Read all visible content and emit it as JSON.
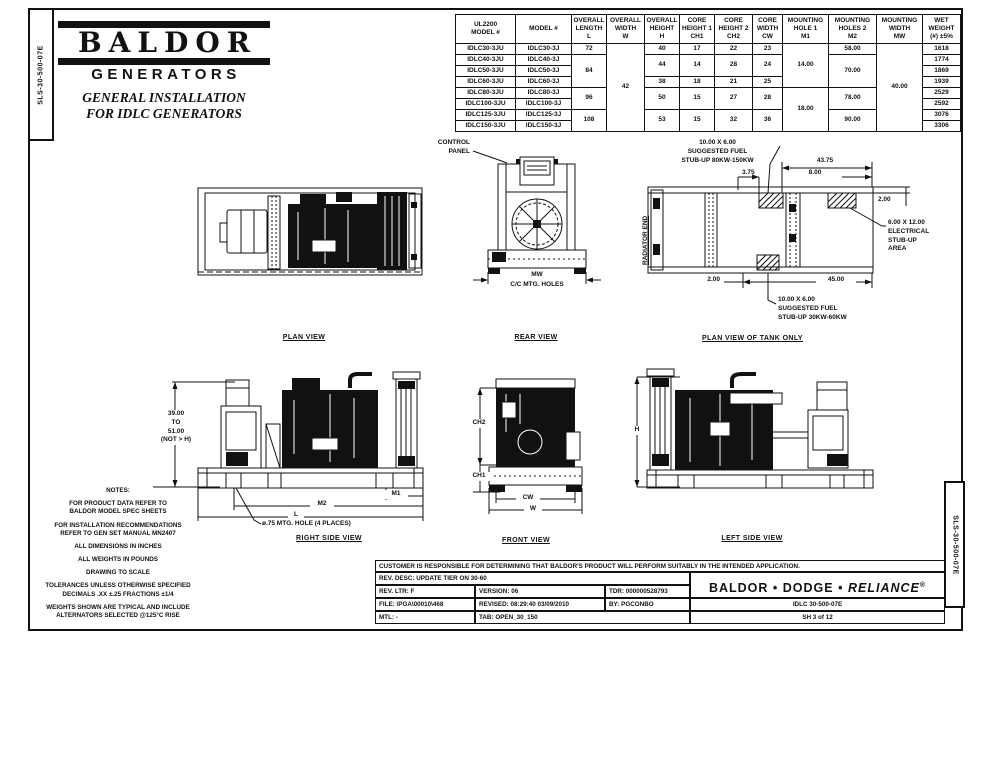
{
  "colors": {
    "ink": "#111111",
    "paper": "#ffffff"
  },
  "page": {
    "side_code": "SLS-30-500-07E"
  },
  "logo": {
    "brand": "BALDOR",
    "division": "GENERATORS",
    "subtitle": "GENERAL INSTALLATION\nFOR IDLC GENERATORS"
  },
  "table": {
    "headers": [
      "UL2200\nMODEL #",
      "MODEL #",
      "OVERALL\nLENGTH\nL",
      "OVERALL\nWIDTH\nW",
      "OVERALL\nHEIGHT\nH",
      "CORE\nHEIGHT 1\nCH1",
      "CORE\nHEIGHT 2\nCH2",
      "CORE\nWIDTH\nCW",
      "MOUNTING\nHOLE 1\nM1",
      "MOUNTING\nHOLES 2\nM2",
      "MOUNTING\nWIDTH\nMW",
      "WET\nWEIGHT\n(#) ±5%"
    ],
    "rows": [
      {
        "u": "IDLC30-3JU",
        "m": "IDLC30-3J",
        "l": "72",
        "w": "42",
        "h": "40",
        "ch1": "17",
        "ch2": "22",
        "cw": "23",
        "m1": "14.00",
        "m2": "58.00",
        "mw": "40.00",
        "wt": "1618"
      },
      {
        "u": "IDLC40-3JU",
        "m": "IDLC40-3J",
        "l": "84",
        "h": "44",
        "ch1": "14",
        "ch2": "28",
        "cw": "24",
        "m2": "70.00",
        "wt": "1774"
      },
      {
        "u": "IDLC50-3JU",
        "m": "IDLC50-3J",
        "wt": "1869"
      },
      {
        "u": "IDLC60-3JU",
        "m": "IDLC60-3J",
        "h": "38",
        "ch1": "18",
        "ch2": "21",
        "cw": "25",
        "wt": "1939"
      },
      {
        "u": "IDLC80-3JU",
        "m": "IDLC80-3J",
        "l": "96",
        "h": "50",
        "ch1": "15",
        "ch2": "27",
        "cw": "28",
        "m1": "18.00",
        "m2": "78.00",
        "wt": "2529"
      },
      {
        "u": "IDLC100-3JU",
        "m": "IDLC100-3J",
        "wt": "2592"
      },
      {
        "u": "IDLC125-3JU",
        "m": "IDLC125-3J",
        "l": "108",
        "h": "53",
        "ch1": "15",
        "ch2": "32",
        "cw": "36",
        "m2": "90.00",
        "wt": "3076"
      },
      {
        "u": "IDLC150-3JU",
        "m": "IDLC150-3J",
        "wt": "3306"
      }
    ]
  },
  "views": {
    "plan": {
      "label": "PLAN VIEW"
    },
    "rear": {
      "label": "REAR VIEW",
      "control_panel": "CONTROL\nPANEL",
      "dim_mw": "MW",
      "dim_mw_note": "C/C MTG. HOLES"
    },
    "tank": {
      "label": "PLAN VIEW OF TANK ONLY",
      "radiator_end": "RADIATOR END",
      "fuel_top": "10.00 X 6.00\nSUGGESTED FUEL\nSTUB-UP 80KW-150KW",
      "fuel_bottom": "10.00 X 6.00\nSUGGESTED FUEL\nSTUB-UP 30KW-60KW",
      "electrical": "6.00 X 12.00\nELECTRICAL\nSTUB-UP\nAREA",
      "dim_43_75": "43.75",
      "dim_3_75": "3.75",
      "dim_8_00": "8.00",
      "dim_2_00_right": "2.00",
      "dim_2_00_left": "2.00",
      "dim_45_00": "45.00"
    },
    "right_side": {
      "label": "RIGHT SIDE VIEW",
      "dim_height": "39.00\nTO\n51.00\n(NOT > H)",
      "dim_m1": "M1",
      "dim_m2": "M2",
      "dim_l": "L",
      "mtg_note": "ø.75 MTG. HOLE (4 PLACES)"
    },
    "front": {
      "label": "FRONT VIEW",
      "dim_ch2": "CH2",
      "dim_ch1": "CH1",
      "dim_cw": "CW",
      "dim_w": "W"
    },
    "left_side": {
      "label": "LEFT SIDE VIEW",
      "dim_h": "H"
    }
  },
  "notes": {
    "title": "NOTES:",
    "items": [
      "FOR PRODUCT DATA REFER TO\nBALDOR MODEL SPEC SHEETS",
      "FOR INSTALLATION RECOMMENDATIONS\nREFER TO GEN SET MANUAL MN2407",
      "ALL DIMENSIONS IN INCHES",
      "ALL WEIGHTS IN POUNDS",
      "DRAWING TO SCALE",
      "TOLERANCES UNLESS OTHERWISE SPECIFIED\nDECIMALS .XX ±.25   FRACTIONS ±1/4",
      "WEIGHTS SHOWN ARE TYPICAL AND INCLUDE\nALTERNATORS SELECTED @125°C RISE"
    ]
  },
  "title_block": {
    "disclaimer": "CUSTOMER IS RESPONSIBLE FOR DETERMINING THAT BALDOR'S PRODUCT WILL PERFORM SUITABLY IN THE INTENDED APPLICATION.",
    "rev_desc": "REV. DESC:  UPDATE TIER ON 30-60",
    "rev_ltr": "REV. LTR:  F",
    "version": "VERSION: 06",
    "tdr": "TDR: 000000528793",
    "file": "FILE: \\PGA\\00010\\468",
    "revised": "REVISED: 08:29:40  03/09/2010",
    "by": "BY:  PGCONBO",
    "mtl": "MTL: -",
    "tab": "TAB:   OPEN_30_150",
    "brand_baldor": "BALDOR",
    "brand_sep": "•",
    "brand_dodge": "DODGE",
    "brand_reliance": "RELIANCE",
    "brand_reg": "®",
    "doc_code": "IDLC 30-500-07E",
    "sheet": "SH 3 of 12"
  }
}
